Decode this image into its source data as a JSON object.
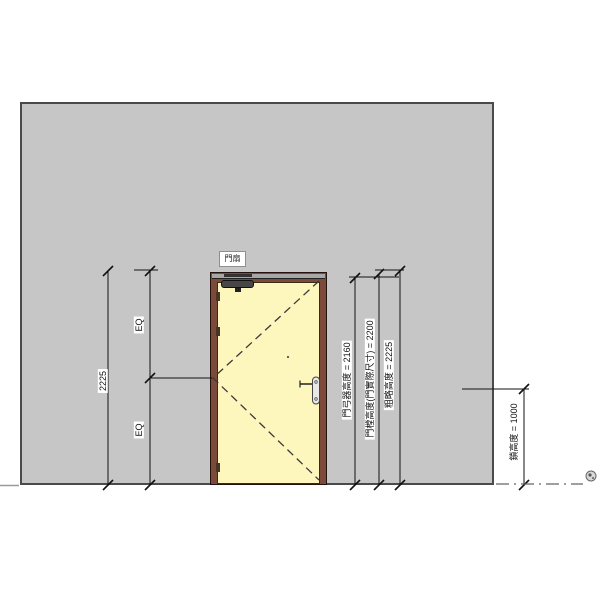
{
  "drawing": {
    "door_tag": "門扇",
    "dims": {
      "overall_height": "2225",
      "eq_top": "EQ",
      "eq_bottom": "EQ",
      "closer_height": "門弓器高度 = 2160",
      "panel_height": "門樘高度(門實際尺寸) = 2200",
      "rough_height": "粗略高度 = 2225",
      "lock_height": "鎖高度 = 1000"
    },
    "colors": {
      "wall_fill": "#c6c6c6",
      "wall_border": "#4a4a4a",
      "door_frame": "#7b4a3a",
      "door_leaf": "#fdf6bd",
      "annotation_line": "#111111"
    }
  }
}
